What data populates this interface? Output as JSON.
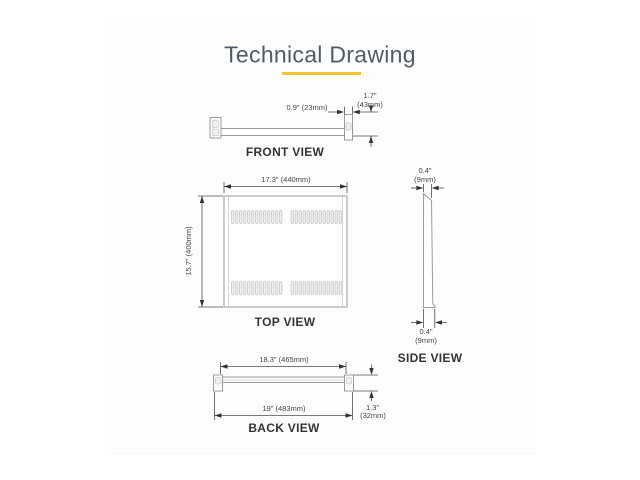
{
  "title": "Technical Drawing",
  "theme": {
    "title_color": "#525a64",
    "accent_underline_color": "#f1c232",
    "shape_line_color": "#9b9b9b",
    "dimension_color": "#454545"
  },
  "front_view": {
    "caption": "FRONT VIEW",
    "lip_depth": "0.9\" (23mm)",
    "height_in": "1.7\"",
    "height_mm": "(43mm)"
  },
  "top_view": {
    "caption": "TOP VIEW",
    "width": "17.3\" (440mm)",
    "depth": "15.7\" (400mm)"
  },
  "side_view": {
    "caption": "SIDE VIEW",
    "top_thickness_in": "0.4\"",
    "top_thickness_mm": "(9mm)",
    "bottom_thickness_in": "0.4\"",
    "bottom_thickness_mm": "(9mm)"
  },
  "back_view": {
    "caption": "BACK VIEW",
    "flange_width": "18.3\" (465mm)",
    "overall_width": "19\" (483mm)",
    "height_in": "1.3\"",
    "height_mm": "(32mm)"
  }
}
